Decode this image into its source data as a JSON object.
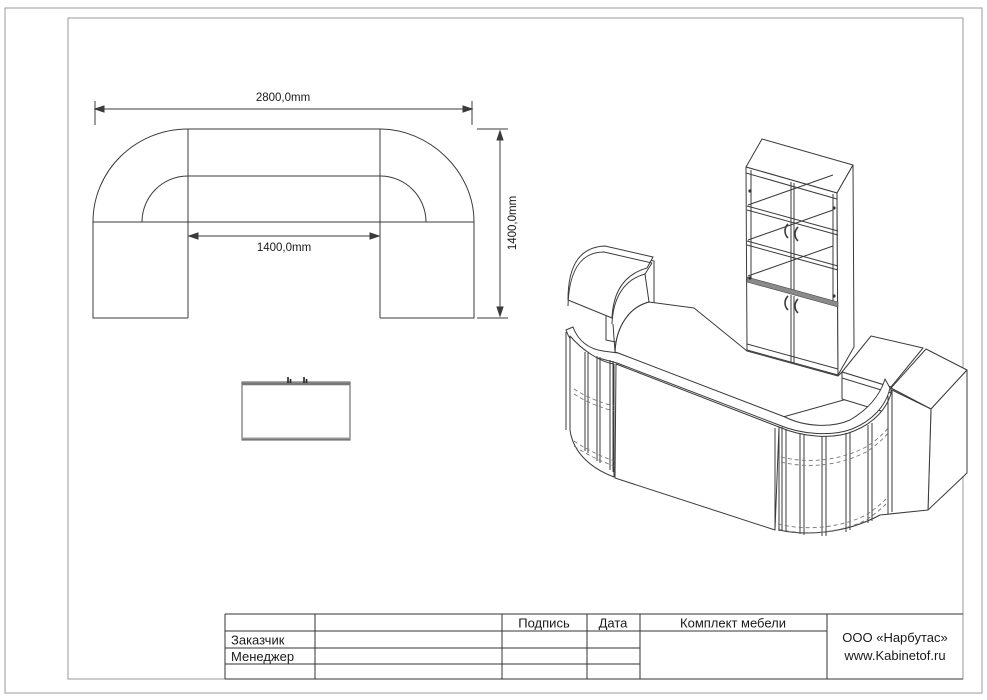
{
  "drawing": {
    "type": "furniture technical drawing",
    "views": {
      "plan": "reception desk top view",
      "front": "cabinet front view",
      "iso": "reception desk with glass cabinet isometric view"
    }
  },
  "dimensions": {
    "width": "2800,0mm",
    "inner_width": "1400,0mm",
    "depth": "1400,0mm"
  },
  "title_block": {
    "headers": {
      "signature": "Подпись",
      "date": "Дата",
      "set": "Комплект мебели"
    },
    "rows": [
      {
        "label": "Заказчик"
      },
      {
        "label": "Менеджер"
      },
      {
        "label": ""
      }
    ],
    "company": {
      "name": "ООО «Нарбутас»",
      "website": "www.Kabinetof.ru"
    }
  },
  "colors": {
    "line": "#3b3b3b",
    "frame_border": "#9a9a9a",
    "table_line": "#333333",
    "dash": "#777777",
    "heavy_band": "#8a8a8a",
    "background": "#ffffff"
  }
}
